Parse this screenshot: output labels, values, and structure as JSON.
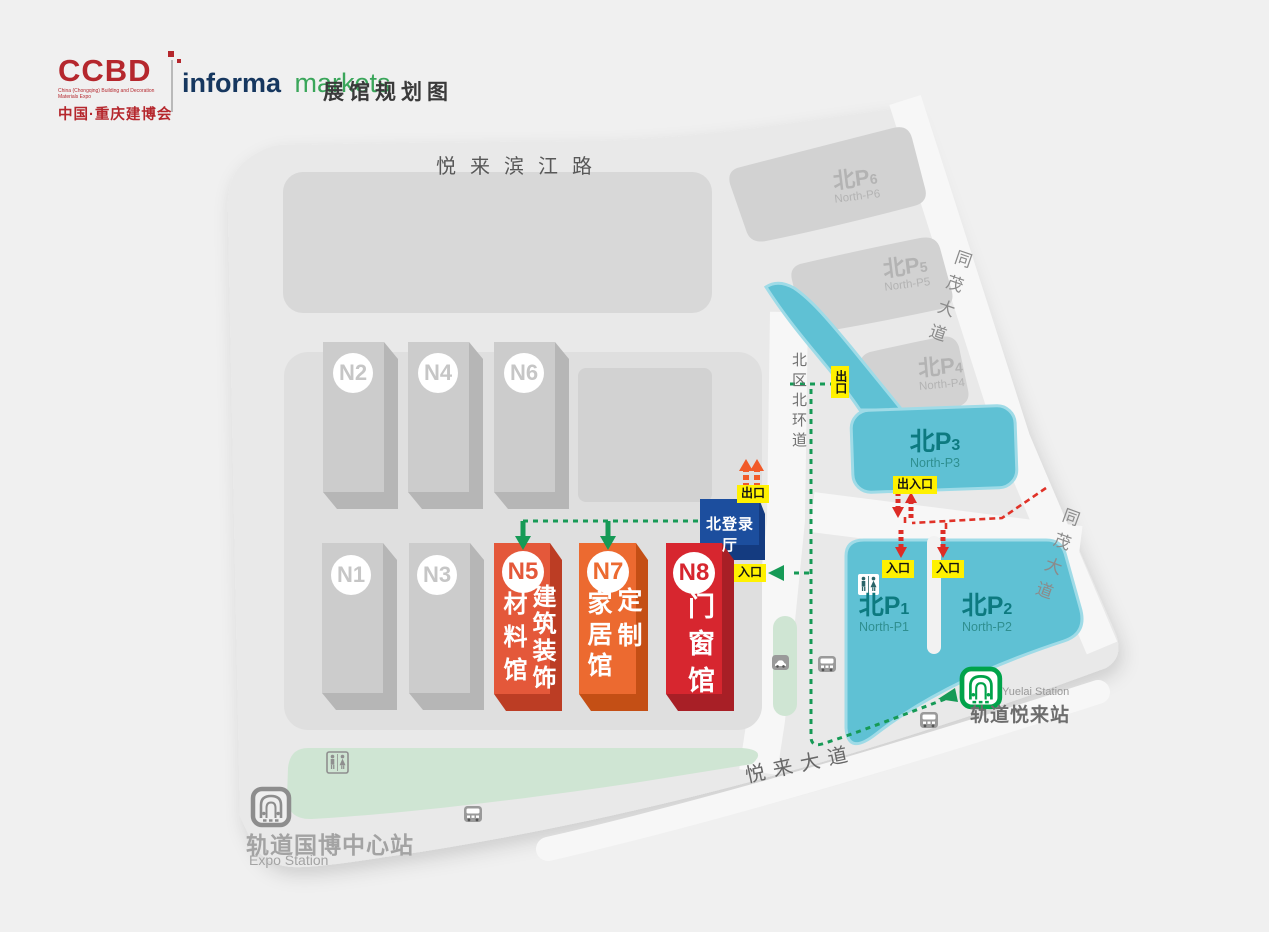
{
  "header": {
    "logo": {
      "acronym": "CCBD",
      "tagline": "China (Chongqing) Building and Decoration Materials Expo",
      "name_cn": "中国·重庆建博会"
    },
    "brand": {
      "word1": "informa",
      "word2": "markets"
    },
    "title": "展馆规划图"
  },
  "roads": {
    "north": "悦来滨江路",
    "east_upper": "同茂大道",
    "east_lower": "同茂大道",
    "ring": "北区北环道",
    "south": "悦来大道"
  },
  "halls": {
    "n1": {
      "id": "N1"
    },
    "n2": {
      "id": "N2"
    },
    "n3": {
      "id": "N3"
    },
    "n4": {
      "id": "N4"
    },
    "n6": {
      "id": "N6"
    },
    "n5": {
      "id": "N5",
      "col_right": "建筑装饰",
      "col_left": "材料馆"
    },
    "n7": {
      "id": "N7",
      "col_right": "定制",
      "col_left": "家居馆"
    },
    "n8": {
      "id": "N8",
      "col": "门窗馆"
    },
    "registration": {
      "name": "北登录厅"
    }
  },
  "parking": {
    "p1": {
      "prefix": "北P",
      "num": "1",
      "sub": "North-P1"
    },
    "p2": {
      "prefix": "北P",
      "num": "2",
      "sub": "North-P2"
    },
    "p3": {
      "prefix": "北P",
      "num": "3",
      "sub": "North-P3"
    },
    "p4": {
      "prefix": "北P",
      "num": "4",
      "sub": "North-P4"
    },
    "p5": {
      "prefix": "北P",
      "num": "5",
      "sub": "North-P5"
    },
    "p6": {
      "prefix": "北P",
      "num": "6",
      "sub": "North-P6"
    }
  },
  "gates": {
    "exit_north": "出口",
    "exit_entrance_p3": "出入口",
    "entrance_p1": "入口",
    "entrance_p2": "入口",
    "reg_exit": "出口",
    "reg_entrance": "入口"
  },
  "stations": {
    "yuelai": {
      "cn": "轨道悦来站",
      "en": "Yuelai Station"
    },
    "expo": {
      "cn": "轨道国博中心站",
      "en": "Expo Station"
    }
  },
  "icons": {
    "restroom": "restroom-icon",
    "bus": "bus-stop-icon",
    "taxi": "taxi-stand-icon",
    "metro": "metro-station-icon"
  },
  "colors": {
    "hall_n5": "#e4583a",
    "hall_n7": "#ec6a30",
    "hall_n8": "#d7262f",
    "registration_blue": "#1c4e9e",
    "parking_cyan": "#5fc1d4",
    "walk_route_green": "#169a56",
    "car_route_red": "#e03228",
    "gate_yellow": "#fff100",
    "metro_green": "#00a34a",
    "brand_red": "#b5272d"
  }
}
